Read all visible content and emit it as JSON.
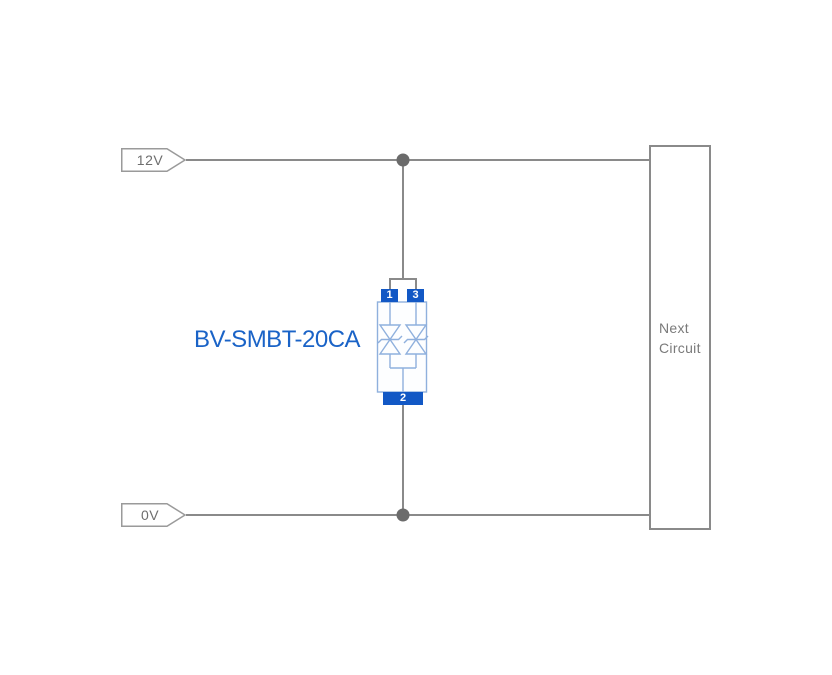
{
  "nets": [
    {
      "label": "12V"
    },
    {
      "label": "0V"
    }
  ],
  "component": {
    "name": "BV-SMBT-20CA",
    "type": "bidirectional TVS diode array",
    "pins": {
      "top_left": "1",
      "top_right": "3",
      "bottom": "2"
    }
  },
  "next_circuit": {
    "line1": "Next",
    "line2": "Circuit"
  },
  "colors": {
    "wire": "#8a8a8a",
    "junction": "#6b6b6b",
    "tag_border": "#9a9a9a",
    "tag_text": "#6e6e6e",
    "pad_blue": "#1258c5",
    "symbol_blue": "#8fb0dd",
    "label_blue": "#1a63c7",
    "box_border": "#8a8a8a",
    "box_text": "#7a7a7a",
    "background": "#ffffff"
  }
}
